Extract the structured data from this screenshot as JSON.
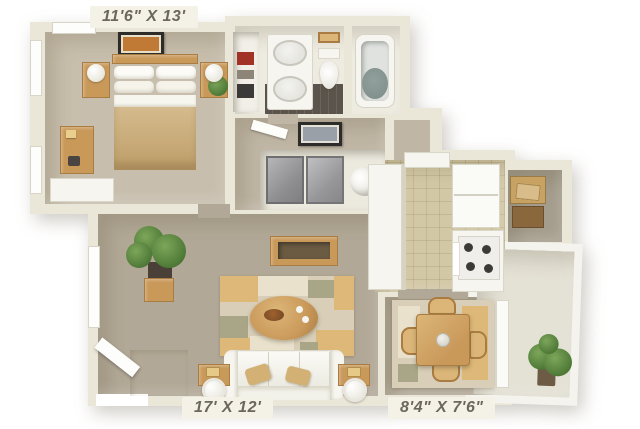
{
  "title": "3D one-bedroom apartment floor plan",
  "labels": {
    "bedroom": "11'6\" X 13'",
    "living_room": "17' X 12'",
    "dining": "8'4\" X 7'6\""
  },
  "rooms": {
    "bedroom": {
      "dimensions": "11'6\" X 13'",
      "contents": [
        "double bed",
        "two nightstands with lamps",
        "dresser",
        "low white cabinet",
        "wall art",
        "windows",
        "small plant"
      ]
    },
    "bathroom": {
      "contents": [
        "double-sink vanity",
        "toilet",
        "shelf basket",
        "bathtub",
        "dark tile floor"
      ]
    },
    "linen_closet": {
      "contents": [
        "shelves with stored items"
      ]
    },
    "hallway": {
      "contents": [
        "door",
        "framed wall art"
      ]
    },
    "laundry_closet": {
      "contents": [
        "gray sliding doors",
        "washer"
      ]
    },
    "living_room": {
      "dimensions": "17' X 12'",
      "contents": [
        "white sofa with tan pillows",
        "oval coffee table",
        "patchwork area rug",
        "console bench",
        "two end tables with round lamps",
        "potted plant",
        "cube side table",
        "tiled entry with front door",
        "window"
      ]
    },
    "kitchen": {
      "contents": [
        "refrigerator",
        "stove with four burners",
        "peninsula counter",
        "upper cabinets",
        "tile floor"
      ]
    },
    "dining_area": {
      "dimensions": "8'4\" X 7'6\"",
      "contents": [
        "square dining table",
        "four chairs",
        "rug",
        "patio door"
      ]
    },
    "storage_closet": {
      "contents": [
        "stacked boxes"
      ]
    },
    "balcony": {
      "contents": [
        "potted plant",
        "concrete floor",
        "railing walls"
      ]
    }
  },
  "colors": {
    "background": "#ffffff",
    "wall": "#ebe7d8",
    "wall_shade": "#d8d3c0",
    "carpet_bedroom": "#c8bead",
    "carpet_living": "#b2a897",
    "carpet_hall": "#c0b6a5",
    "bath_floor": "#eeebe0",
    "tile_bath_dark": "#5a544c",
    "tile_kitchen": "#e8e2cd",
    "tile_grid": "#d6cfb8",
    "tile_entry": "#f5f4ef",
    "wood": "#c9995a",
    "wood_light": "#dcb678",
    "wood_dark": "#a87c42",
    "white_furniture": "#f6f5f0",
    "sofa": "#f1f0e9",
    "pillow_tan": "#d3b175",
    "rug_base": "#d9cfb8",
    "rug_tan": "#ddb878",
    "rug_olive": "#a9a687",
    "rug_cream": "#e9e1cc",
    "plant_green": "#55803c",
    "plant_dark": "#3e6329",
    "plant_light": "#7da65a",
    "tub_water": "#7d8c89",
    "closet_door": "#a3a2a4",
    "art_orange": "#c07a35",
    "art_gray": "#9aa0a8",
    "label_bg": "#f4f2e6",
    "label_text": "#6b675e",
    "box_brown": "#8a673c",
    "box_tan": "#c7a263",
    "storage_floor": "#a49c8c",
    "balcony_wall": "#f4f3ed",
    "balcony_floor": "#e4e1d5"
  }
}
